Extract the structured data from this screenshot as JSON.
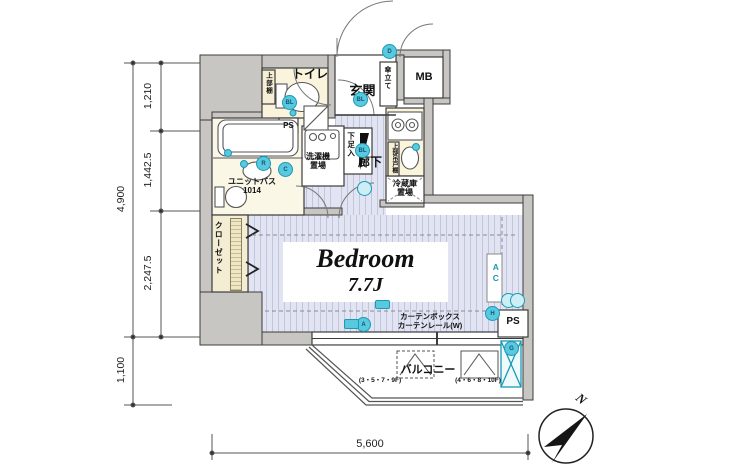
{
  "rooms": {
    "toilet": "トイレ",
    "entrance": "玄関",
    "meter_box": "MB",
    "pipe_space": "PS",
    "laundry": [
      "洗濯機",
      "置場"
    ],
    "shoe_cabinet": "下足入",
    "corridor": "廊下",
    "fridge": [
      "冷蔵庫",
      "置場"
    ],
    "unit_bath": [
      "ユニットバス",
      "1014"
    ],
    "closet": "クローゼット",
    "umbrella_stand": "傘立て",
    "toilet_shelf": "上部棚",
    "kitchen_shelf": "上部吊戸棚",
    "bedroom": {
      "name": "Bedroom",
      "size": "7.7J"
    },
    "balcony": {
      "label": "バルコニー",
      "floors_left": "(3・5・7・9F)",
      "floors_right": "(4・6・8・10F)"
    },
    "curtain": [
      "カーテンボックス",
      "カーテンレール(W)"
    ],
    "ac": "AC"
  },
  "markers": {
    "d": "D",
    "bl": "BL",
    "r": "R",
    "c": "C",
    "a": "A",
    "h": "H",
    "g": "G"
  },
  "dimensions": {
    "left_total": "4,900",
    "left_top": "1,210",
    "left_mid": "1,442.5",
    "left_bottom": "2,247.5",
    "lower": "1,100",
    "bottom": "5,600"
  },
  "compass": {
    "north": "N"
  },
  "colors": {
    "wall": "#c7c6c2",
    "cream": "#faf4dc",
    "stripe_bg": "#e2e4f2",
    "stripe_line": "#bfc6e0",
    "cyan": "#5ac8de",
    "cyan_dark": "#1a9ab5",
    "outline": "#3c3c3c"
  }
}
